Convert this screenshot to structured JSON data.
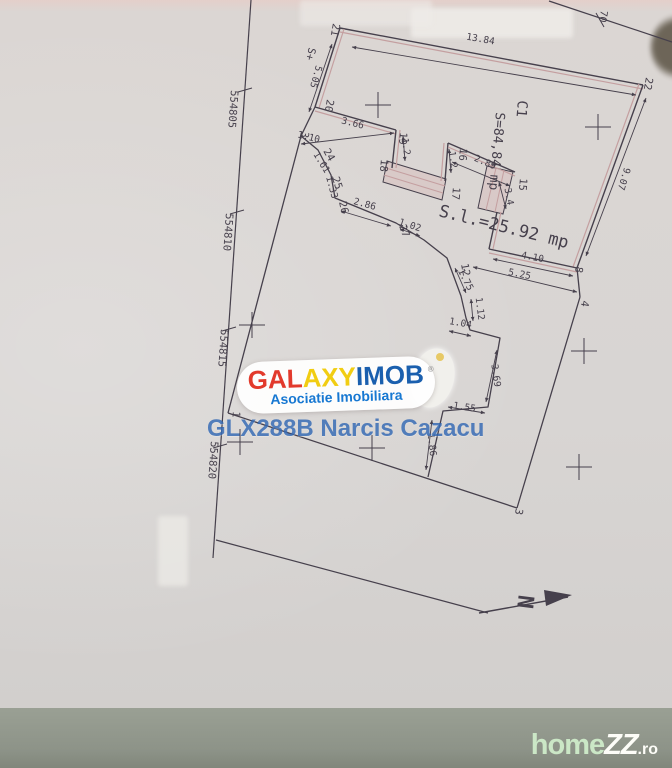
{
  "watermarks": {
    "galaxyimob": {
      "part1": "GAL",
      "part2": "AXY",
      "part3": "IMOB",
      "registered": "®",
      "subtitle": "Asociatie Imobiliara",
      "colors": {
        "part1": "#e23a2c",
        "part2": "#f1cd12",
        "part3": "#1a5fae",
        "subtitle": "#1778d2"
      }
    },
    "agent_code": "GLX288B Narcis Cazacu",
    "homezz": {
      "part1": "home",
      "part2": "ZZ",
      "part3": ".ro"
    }
  },
  "plan": {
    "colors": {
      "ink": "#46404c",
      "pink": "#c49fa0",
      "bandFill": "rgba(216,186,186,0.45)"
    },
    "polylines": [
      {
        "name": "grid-line-left",
        "pts": [
          [
            251,
            0
          ],
          [
            213,
            558
          ]
        ],
        "c": "ink",
        "w": 1.2
      },
      {
        "name": "grid-line-topright",
        "pts": [
          [
            549,
            1
          ],
          [
            672,
            42
          ]
        ],
        "c": "ink",
        "w": 1.2
      },
      {
        "name": "boundary-west",
        "pts": [
          [
            301,
            136
          ],
          [
            228,
            413
          ]
        ],
        "c": "ink",
        "w": 1.3
      },
      {
        "name": "boundary-south",
        "pts": [
          [
            228,
            413
          ],
          [
            517,
            508
          ]
        ],
        "c": "ink",
        "w": 1.3
      },
      {
        "name": "boundary-east-lower",
        "pts": [
          [
            580,
            297
          ],
          [
            517,
            508
          ]
        ],
        "c": "ink",
        "w": 1.3
      },
      {
        "name": "boundary-8-4",
        "pts": [
          [
            577,
            268
          ],
          [
            580,
            297
          ]
        ],
        "c": "ink",
        "w": 1.3
      },
      {
        "name": "boundary-bottom-branch",
        "pts": [
          [
            216,
            540
          ],
          [
            488,
            613
          ]
        ],
        "c": "ink",
        "w": 1.2
      },
      {
        "name": "boundary-20-3",
        "pts": [
          [
            315,
            107
          ],
          [
            301,
            136
          ]
        ],
        "c": "ink",
        "w": 1.3
      },
      {
        "name": "courtyard-jog",
        "pts": [
          [
            301,
            136
          ],
          [
            318,
            150
          ],
          [
            331,
            175
          ],
          [
            335,
            198
          ],
          [
            396,
            223
          ],
          [
            424,
            240
          ],
          [
            447,
            258
          ],
          [
            461,
            296
          ],
          [
            466,
            318
          ],
          [
            470,
            330
          ],
          [
            500,
            338
          ],
          [
            488,
            407
          ],
          [
            443,
            411
          ],
          [
            428,
            477
          ]
        ],
        "c": "ink",
        "w": 1.3
      },
      {
        "name": "stairs-line",
        "pts": [
          [
            386,
            168
          ],
          [
            445,
            186
          ]
        ],
        "c": "pink",
        "w": 1
      },
      {
        "name": "stairs-line",
        "pts": [
          [
            384,
            175
          ],
          [
            443,
            193
          ]
        ],
        "c": "pink",
        "w": 1
      },
      {
        "name": "stairs-line",
        "pts": [
          [
            496,
            168
          ],
          [
            486,
            210
          ]
        ],
        "c": "pink",
        "w": 1
      },
      {
        "name": "stairs-line",
        "pts": [
          [
            504,
            170
          ],
          [
            495,
            212
          ]
        ],
        "c": "pink",
        "w": 1
      }
    ],
    "walls": [
      {
        "name": "wall-21-22",
        "pts": [
          [
            340,
            28
          ],
          [
            643,
            85
          ]
        ],
        "off": [
          0,
          4
        ]
      },
      {
        "name": "wall-22-8",
        "pts": [
          [
            643,
            85
          ],
          [
            577,
            268
          ]
        ],
        "off": [
          -4,
          -1
        ]
      },
      {
        "name": "wall-21-20",
        "pts": [
          [
            340,
            28
          ],
          [
            315,
            107
          ]
        ],
        "off": [
          4,
          1
        ]
      },
      {
        "name": "wall-20-19",
        "pts": [
          [
            315,
            107
          ],
          [
            396,
            130
          ]
        ],
        "off": [
          0,
          4
        ]
      },
      {
        "name": "wall-19-18",
        "pts": [
          [
            396,
            130
          ],
          [
            392,
            168
          ]
        ],
        "off": [
          4,
          0
        ]
      },
      {
        "name": "wall-17-16",
        "pts": [
          [
            445,
            181
          ],
          [
            448,
            143
          ]
        ],
        "off": [
          -4,
          0
        ]
      },
      {
        "name": "wall-16-15",
        "pts": [
          [
            448,
            143
          ],
          [
            515,
            172
          ]
        ],
        "off": [
          0,
          4
        ]
      },
      {
        "name": "wall-15-down",
        "pts": [
          [
            497,
            212
          ],
          [
            489,
            249
          ]
        ],
        "off": [
          4,
          0
        ]
      },
      {
        "name": "wall-corner-8",
        "pts": [
          [
            489,
            249
          ],
          [
            577,
            268
          ]
        ],
        "off": [
          0,
          4
        ]
      }
    ],
    "bands": [
      {
        "name": "stairs-band-1",
        "poly": [
          [
            387,
            161
          ],
          [
            446,
            179
          ],
          [
            442,
            200
          ],
          [
            383,
            182
          ]
        ]
      },
      {
        "name": "stairs-band-2",
        "poly": [
          [
            487,
            166
          ],
          [
            513,
            172
          ],
          [
            503,
            214
          ],
          [
            478,
            208
          ]
        ]
      }
    ],
    "dims": [
      {
        "t": "13.84",
        "x": 480,
        "y": 42,
        "r": 10,
        "line": [
          352,
          47,
          636,
          95
        ]
      },
      {
        "t": "5.05",
        "x": 313,
        "y": 76,
        "r": 105,
        "line": [
          332,
          44,
          309,
          112
        ]
      },
      {
        "t": "9.07",
        "x": 621,
        "y": 178,
        "r": 107,
        "line": [
          646,
          98,
          586,
          256
        ]
      },
      {
        "t": "3.66",
        "x": 352,
        "y": 126,
        "r": 14,
        "line": [
          301,
          144,
          394,
          133
        ]
      },
      {
        "t": "1.10",
        "x": 308,
        "y": 140,
        "r": 14
      },
      {
        "t": "2.86",
        "x": 364,
        "y": 207,
        "r": 15,
        "line": [
          341,
          211,
          391,
          226
        ]
      },
      {
        "t": "1.61",
        "x": 319,
        "y": 164,
        "r": 58
      },
      {
        "t": "1.33",
        "x": 329,
        "y": 188,
        "r": 75
      },
      {
        "t": "1.02",
        "x": 409,
        "y": 228,
        "r": 18,
        "line": [
          400,
          229,
          420,
          236
        ]
      },
      {
        "t": "1.75",
        "x": 463,
        "y": 281,
        "r": 63,
        "line": [
          455,
          268,
          466,
          293
        ]
      },
      {
        "t": "1.12",
        "x": 477,
        "y": 309,
        "r": 83,
        "line": [
          471,
          299,
          473,
          321
        ]
      },
      {
        "t": "1.04",
        "x": 460,
        "y": 326,
        "r": 10,
        "line": [
          449,
          331,
          471,
          336
        ]
      },
      {
        "t": "3.69",
        "x": 493,
        "y": 376,
        "r": 82,
        "line": [
          497,
          350,
          486,
          402
        ]
      },
      {
        "t": "1.55",
        "x": 464,
        "y": 410,
        "r": 9,
        "line": [
          448,
          407,
          485,
          413
        ]
      },
      {
        "t": "1.86",
        "x": 429,
        "y": 445,
        "r": 84,
        "line": [
          432,
          420,
          426,
          470
        ]
      },
      {
        "t": "4.10",
        "x": 532,
        "y": 260,
        "r": 11,
        "line": [
          493,
          259,
          573,
          276
        ]
      },
      {
        "t": "5.25",
        "x": 519,
        "y": 277,
        "r": 11,
        "line": [
          473,
          267,
          577,
          292
        ]
      },
      {
        "t": "2.89",
        "x": 484,
        "y": 165,
        "r": 23,
        "line": [
          452,
          162,
          510,
          186
        ]
      },
      {
        "t": "3.4",
        "x": 506,
        "y": 197,
        "r": 80,
        "line": [
          499,
          182,
          506,
          209
        ]
      },
      {
        "t": "1.2",
        "x": 403,
        "y": 147,
        "r": 82,
        "line": [
          403,
          136,
          405,
          161
        ]
      },
      {
        "t": "1.2",
        "x": 450,
        "y": 160,
        "r": 82,
        "line": [
          449,
          149,
          451,
          173
        ]
      }
    ],
    "labels": [
      {
        "t": "C1",
        "x": 518,
        "y": 100,
        "r": 95,
        "s": 14
      },
      {
        "t": "S=84,84 mp",
        "x": 496,
        "y": 112,
        "r": 95,
        "s": 13
      },
      {
        "t": "S.l.=25.92 mp",
        "x": 438,
        "y": 216,
        "r": 14,
        "s": 17
      },
      {
        "t": "554805",
        "x": 231,
        "y": 90,
        "r": 94,
        "s": 10.5
      },
      {
        "t": "554810",
        "x": 226,
        "y": 213,
        "r": 94,
        "s": 10.5
      },
      {
        "t": "554815",
        "x": 221,
        "y": 329,
        "r": 94,
        "s": 10.5
      },
      {
        "t": "554820",
        "x": 211,
        "y": 441,
        "r": 94,
        "s": 10.5
      },
      {
        "t": "70",
        "x": 601,
        "y": 10,
        "r": 100,
        "s": 10
      },
      {
        "t": "S+",
        "x": 309,
        "y": 47,
        "r": 105,
        "s": 10.5
      },
      {
        "t": "21",
        "x": 333,
        "y": 23,
        "r": 100,
        "s": 10.5
      },
      {
        "t": "22",
        "x": 646,
        "y": 77,
        "r": 100,
        "s": 10.5
      },
      {
        "t": "20",
        "x": 327,
        "y": 99,
        "r": 100,
        "s": 10.5
      },
      {
        "t": "19",
        "x": 400,
        "y": 132,
        "r": 95,
        "s": 10.5
      },
      {
        "t": "18",
        "x": 381,
        "y": 159,
        "r": 95,
        "s": 10.5
      },
      {
        "t": "17",
        "x": 453,
        "y": 187,
        "r": 95,
        "s": 10.5
      },
      {
        "t": "16",
        "x": 460,
        "y": 148,
        "r": 95,
        "s": 10.5
      },
      {
        "t": "15",
        "x": 520,
        "y": 178,
        "r": 95,
        "s": 10.5
      },
      {
        "t": "24",
        "x": 323,
        "y": 151,
        "r": 60,
        "s": 10.5
      },
      {
        "t": "25",
        "x": 332,
        "y": 178,
        "r": 72,
        "s": 10.5
      },
      {
        "t": "26",
        "x": 339,
        "y": 202,
        "r": 78,
        "s": 10.5
      },
      {
        "t": "27",
        "x": 399,
        "y": 226,
        "r": 70,
        "s": 10.5
      },
      {
        "t": "12",
        "x": 461,
        "y": 264,
        "r": 80,
        "s": 10.5
      },
      {
        "t": "8",
        "x": 576,
        "y": 266,
        "r": 100,
        "s": 10.5
      },
      {
        "t": "4",
        "x": 582,
        "y": 300,
        "r": 100,
        "s": 10.5
      },
      {
        "t": "3",
        "x": 302,
        "y": 131,
        "r": 100,
        "s": 10.5
      },
      {
        "t": "3",
        "x": 516,
        "y": 508,
        "r": 100,
        "s": 10.5
      },
      {
        "t": "1",
        "x": 233,
        "y": 411,
        "r": 95,
        "s": 10.5
      }
    ],
    "crosses": [
      [
        378,
        105
      ],
      [
        598,
        127
      ],
      [
        252,
        325
      ],
      [
        240,
        442
      ],
      [
        584,
        351
      ],
      [
        579,
        467
      ],
      [
        372,
        448
      ]
    ],
    "ticks": [
      [
        238,
        92,
        252,
        88
      ],
      [
        230,
        214,
        244,
        210
      ],
      [
        222,
        331,
        236,
        327
      ],
      [
        213,
        448,
        227,
        444
      ],
      [
        596,
        13,
        604,
        27
      ]
    ],
    "north": {
      "label": "N",
      "line": [
        479,
        613,
        568,
        597
      ],
      "head": [
        [
          544,
          590
        ],
        [
          572,
          595
        ],
        [
          546,
          606
        ]
      ],
      "lx": 518,
      "ly": 601,
      "r": 97,
      "s": 22
    }
  }
}
